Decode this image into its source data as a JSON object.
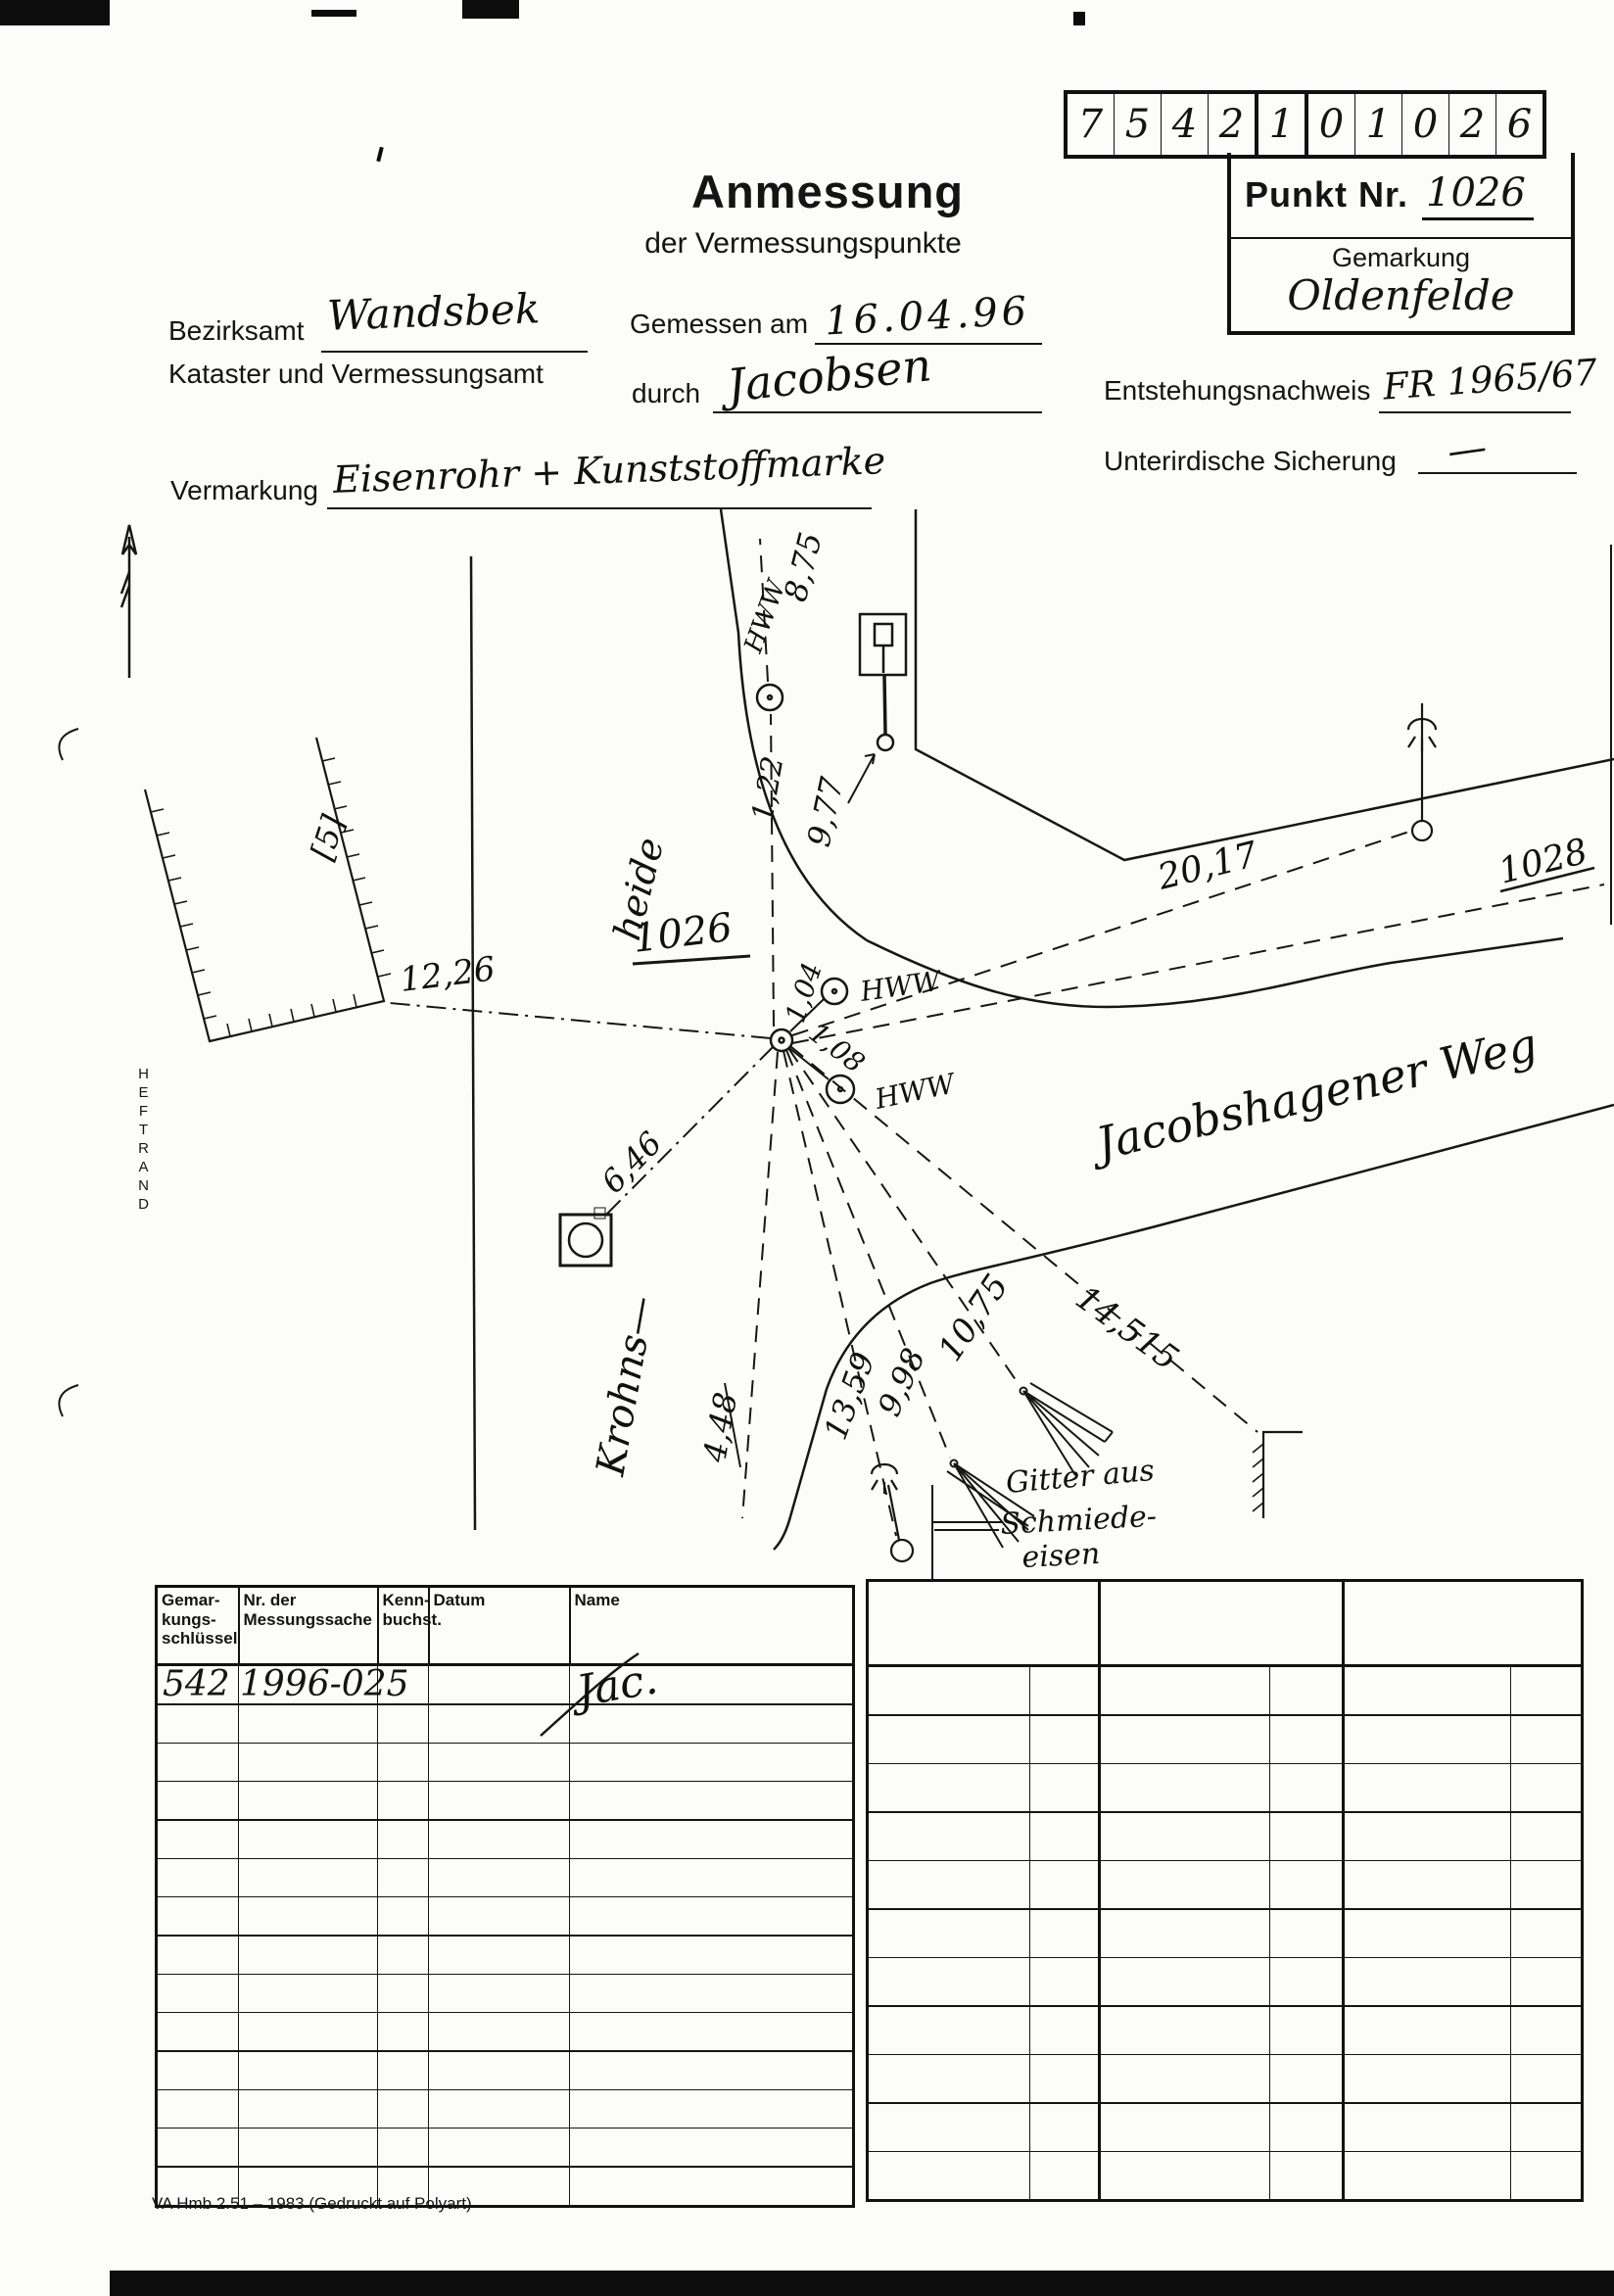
{
  "header": {
    "title": "Anmessung",
    "subtitle": "der Vermessungspunkte",
    "code_cells": [
      "7",
      "5",
      "4",
      "2",
      "1",
      "0",
      "1",
      "0",
      "2",
      "6"
    ],
    "punkt_label": "Punkt Nr.",
    "punkt_value": "1026",
    "gemarkung_label": "Gemarkung",
    "gemarkung_value": "Oldenfelde"
  },
  "form": {
    "bezirksamt_label": "Bezirksamt",
    "bezirksamt_value": "Wandsbek",
    "kataster_line": "Kataster und Vermessungsamt",
    "gemessen_label": "Gemessen am",
    "gemessen_value": "16.04.96",
    "durch_label": "durch",
    "durch_value": "Jacobsen",
    "entstehung_label": "Entstehungsnachweis",
    "entstehung_value": "FR 1965/67",
    "vermarkung_label": "Vermarkung",
    "vermarkung_value": "Eisenrohr + Kunststoffmarke",
    "sicherung_label": "Unterirdische Sicherung",
    "sicherung_value": "—"
  },
  "sketch": {
    "heftrand": "HEFTRAND",
    "point": "1026",
    "point2": "1028",
    "parcel": "[5]",
    "hww": "HWW",
    "street_krohns": "Krohns—",
    "street_heide": "heide",
    "street_weg": "Jacobshagener Weg",
    "fence1": "Gitter aus",
    "fence2": "Schmiede-",
    "fence3": "eisen",
    "m": {
      "d1226": "12,26",
      "d875": "8,75",
      "d122": "1,22",
      "d977": "9,77",
      "d104": "1,04",
      "d108": "1,08",
      "d2017": "20,17",
      "d646": "6,46",
      "d448": "4,48",
      "d1359": "13,59",
      "d998": "9,98",
      "d1075": "10,75",
      "d14515": "14,515"
    }
  },
  "table_left": {
    "headers": [
      "Gemar-\nkungs-\nschlüssel",
      "Nr. der\nMessungssache",
      "Kenn-\nbuchst.",
      "Datum",
      "Name"
    ],
    "row1_schluessel": "542",
    "row1_messungssache": "1996-025",
    "row1_name_sig": "Jac."
  },
  "footer": {
    "text": "VA Hmb 2.51 – 1983 (Gedruckt auf Polyart)"
  }
}
